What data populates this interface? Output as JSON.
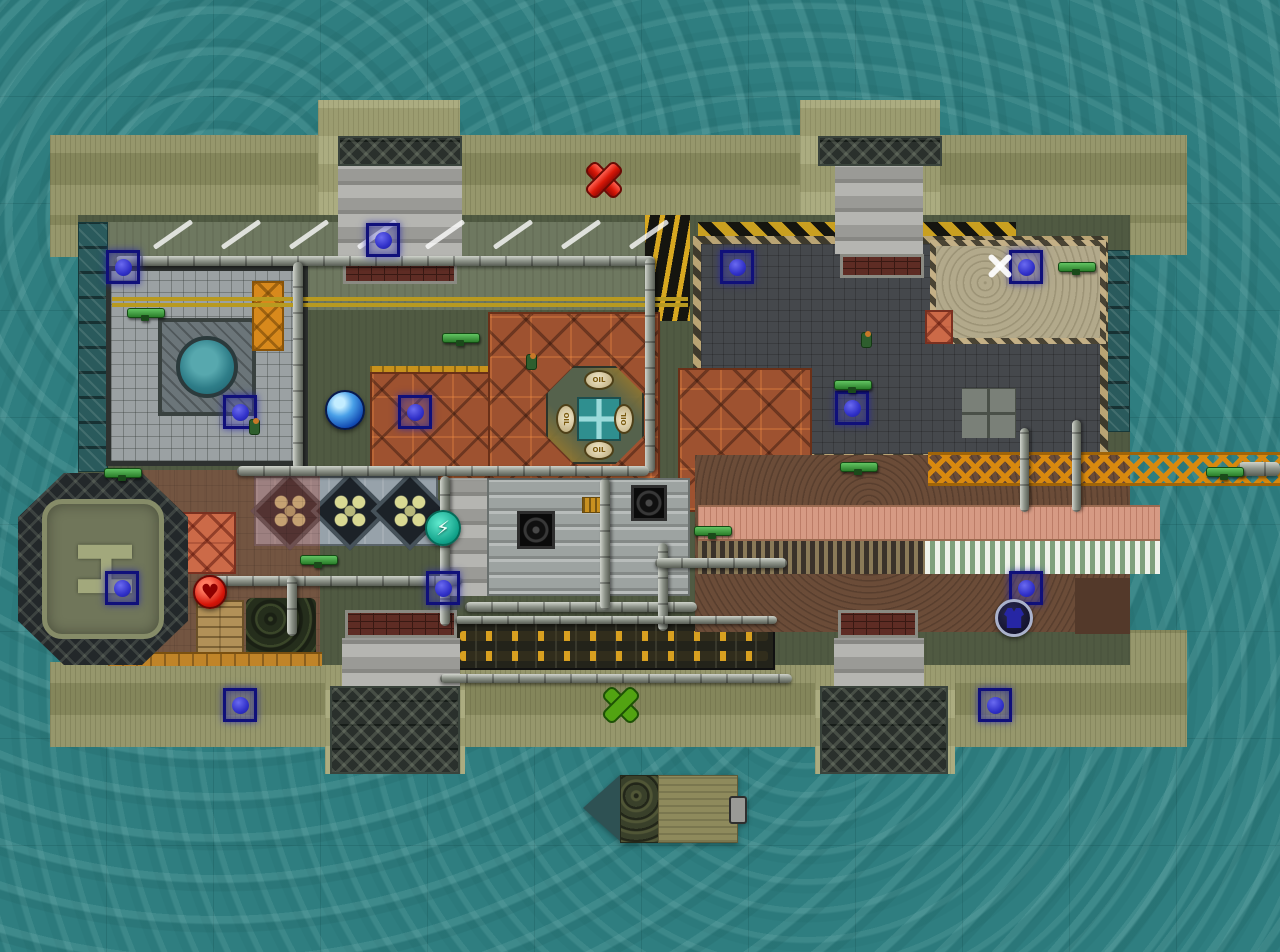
{
  "scene": {
    "name": "industrial-island-game-map",
    "width": 1280,
    "height": 952
  },
  "labels": {
    "helipad": "H",
    "oil": "OIL"
  },
  "glyphs": {
    "lightning": "⚡",
    "heart": "♥"
  },
  "colors": {
    "water": "#2f7e80",
    "dock": "#8f9163",
    "pier": "#a5a677",
    "ground": "#505a42",
    "roof_rust": "#9e5230",
    "marker_border": "#10107a",
    "marker_dot": "#3030c8",
    "pickup_red": "#d81808",
    "pickup_green": "#52a312",
    "lattice_orange": "#d8890f",
    "walkway_pink": "#d69a84",
    "sand": "#b2a98b"
  },
  "zones": [
    {
      "name": "dock-top-band",
      "type": "khaki",
      "x": 50,
      "y": 135,
      "w": 1137,
      "h": 82
    },
    {
      "name": "dock-left-col",
      "type": "khaki",
      "x": 50,
      "y": 215,
      "w": 30,
      "h": 42
    },
    {
      "name": "dock-right-top",
      "type": "khaki",
      "x": 1130,
      "y": 215,
      "w": 57,
      "h": 40
    },
    {
      "name": "dock-bottom-band",
      "type": "khaki",
      "x": 50,
      "y": 662,
      "w": 1137,
      "h": 85
    },
    {
      "name": "dock-bottom-right-step",
      "type": "khaki",
      "x": 1130,
      "y": 630,
      "w": 57,
      "h": 35
    },
    {
      "name": "pier-top-left",
      "type": "khaki-light",
      "x": 318,
      "y": 100,
      "w": 142,
      "h": 120
    },
    {
      "name": "pier-top-right",
      "type": "khaki-light",
      "x": 800,
      "y": 100,
      "w": 140,
      "h": 120
    },
    {
      "name": "pier-bottom-left",
      "type": "khaki-light",
      "x": 325,
      "y": 662,
      "w": 140,
      "h": 112
    },
    {
      "name": "pier-bottom-right",
      "type": "khaki-light",
      "x": 815,
      "y": 662,
      "w": 140,
      "h": 112
    },
    {
      "name": "facility-ground",
      "type": "base",
      "x": 78,
      "y": 215,
      "w": 1052,
      "h": 450
    },
    {
      "name": "dock-panels-left",
      "type": "teal-col",
      "x": 78,
      "y": 222,
      "w": 30,
      "h": 250
    },
    {
      "name": "dock-panels-right",
      "type": "teal-col",
      "x": 1103,
      "y": 250,
      "w": 27,
      "h": 182
    },
    {
      "name": "top-road",
      "type": "road",
      "x": 108,
      "y": 222,
      "w": 582,
      "h": 88
    },
    {
      "name": "no-stop-wavy-strip",
      "type": "wavy",
      "x": 645,
      "y": 215,
      "w": 45,
      "h": 106
    },
    {
      "name": "hazard-strip",
      "type": "hazard",
      "x": 698,
      "y": 222,
      "w": 318,
      "h": 15
    },
    {
      "name": "dark-yard",
      "type": "yard",
      "x": 693,
      "y": 236,
      "w": 415,
      "h": 226
    },
    {
      "name": "sand-patch",
      "type": "sand",
      "x": 930,
      "y": 240,
      "w": 176,
      "h": 104
    },
    {
      "name": "pallet-squares",
      "type": "pallet",
      "x": 962,
      "y": 388,
      "w": 54,
      "h": 50
    },
    {
      "name": "grid-building",
      "type": "grid-bld",
      "x": 106,
      "y": 266,
      "w": 202,
      "h": 200
    },
    {
      "name": "grid-building-ring",
      "type": "ring",
      "x": 158,
      "y": 318,
      "w": 98,
      "h": 98
    },
    {
      "name": "cooling-pool",
      "type": "pool",
      "x": 176,
      "y": 336,
      "w": 62,
      "h": 62
    },
    {
      "name": "orange-crates",
      "type": "crate-orange",
      "x": 252,
      "y": 281,
      "w": 32,
      "h": 70
    },
    {
      "name": "red-crate",
      "type": "crates-red",
      "x": 925,
      "y": 310,
      "w": 28,
      "h": 34
    },
    {
      "name": "gold-beam",
      "type": "goldstrip",
      "x": 370,
      "y": 366,
      "w": 120,
      "h": 7
    },
    {
      "name": "red-roof-left",
      "type": "redroof",
      "x": 370,
      "y": 372,
      "w": 120,
      "h": 108
    },
    {
      "name": "red-roof-center",
      "type": "redroof",
      "x": 488,
      "y": 312,
      "w": 172,
      "h": 168
    },
    {
      "name": "red-roof-right",
      "type": "redroof",
      "x": 678,
      "y": 368,
      "w": 134,
      "h": 144
    },
    {
      "name": "skylight-building",
      "type": "diamond-base",
      "x": 254,
      "y": 476,
      "w": 184,
      "h": 70
    },
    {
      "name": "skylight-diamond",
      "type": "diamond",
      "x": 262,
      "y": 483,
      "w": 56,
      "h": 56
    },
    {
      "name": "skylight-diamond",
      "type": "diamond",
      "x": 322,
      "y": 483,
      "w": 56,
      "h": 56
    },
    {
      "name": "skylight-diamond",
      "type": "diamond",
      "x": 382,
      "y": 483,
      "w": 56,
      "h": 56
    },
    {
      "name": "concrete-block",
      "type": "ramp",
      "x": 447,
      "y": 478,
      "w": 40,
      "h": 118
    },
    {
      "name": "factory-roof",
      "type": "factory",
      "x": 487,
      "y": 478,
      "w": 203,
      "h": 118
    },
    {
      "name": "roof-fan",
      "type": "fan",
      "x": 517,
      "y": 511,
      "w": 38,
      "h": 38
    },
    {
      "name": "roof-fan",
      "type": "fan",
      "x": 631,
      "y": 485,
      "w": 36,
      "h": 36
    },
    {
      "name": "roof-vent",
      "type": "goldvent",
      "x": 582,
      "y": 497,
      "w": 28,
      "h": 16
    },
    {
      "name": "conveyor-line",
      "type": "conveyor",
      "x": 453,
      "y": 622,
      "w": 322,
      "h": 48
    },
    {
      "name": "conveyor-cells",
      "type": "convrow",
      "x": 460,
      "y": 631,
      "w": 308,
      "h": 10
    },
    {
      "name": "conveyor-cells",
      "type": "convrow",
      "x": 460,
      "y": 651,
      "w": 308,
      "h": 10
    },
    {
      "name": "dirt-ground",
      "type": "dirt",
      "x": 695,
      "y": 455,
      "w": 435,
      "h": 177
    },
    {
      "name": "dirt-dark-patch",
      "type": "dirt-dark",
      "x": 1075,
      "y": 578,
      "w": 55,
      "h": 56
    },
    {
      "name": "pink-walkway",
      "type": "walkway",
      "x": 698,
      "y": 505,
      "w": 462,
      "h": 36
    },
    {
      "name": "ribbed-strip",
      "type": "ribbed",
      "x": 698,
      "y": 541,
      "w": 227,
      "h": 33
    },
    {
      "name": "awning-stripes",
      "type": "awning",
      "x": 925,
      "y": 541,
      "w": 235,
      "h": 33
    },
    {
      "name": "crane-lattice",
      "type": "lattice",
      "x": 928,
      "y": 452,
      "w": 352,
      "h": 34
    },
    {
      "name": "pink-tile-area",
      "type": "pink",
      "x": 142,
      "y": 470,
      "w": 178,
      "h": 192
    },
    {
      "name": "red-crates-stack",
      "type": "crates-red",
      "x": 178,
      "y": 512,
      "w": 58,
      "h": 62
    },
    {
      "name": "wood-crates",
      "type": "crates-wood",
      "x": 196,
      "y": 600,
      "w": 48,
      "h": 58
    },
    {
      "name": "hedge",
      "type": "bush",
      "x": 246,
      "y": 598,
      "w": 70,
      "h": 60
    },
    {
      "name": "orange-dock-strip",
      "type": "dockstrip",
      "x": 108,
      "y": 652,
      "w": 214,
      "h": 14
    },
    {
      "name": "pier-truss",
      "type": "truss",
      "x": 338,
      "y": 136,
      "w": 124,
      "h": 30
    },
    {
      "name": "pier-ramp",
      "type": "ramp",
      "x": 338,
      "y": 166,
      "w": 124,
      "h": 90
    },
    {
      "name": "pier-brick",
      "type": "brick",
      "x": 343,
      "y": 256,
      "w": 114,
      "h": 28
    },
    {
      "name": "pier-truss",
      "type": "truss",
      "x": 818,
      "y": 136,
      "w": 124,
      "h": 30
    },
    {
      "name": "pier-ramp",
      "type": "ramp",
      "x": 835,
      "y": 166,
      "w": 88,
      "h": 88
    },
    {
      "name": "pier-brick",
      "type": "brick",
      "x": 840,
      "y": 254,
      "w": 84,
      "h": 24
    },
    {
      "name": "pier-brick",
      "type": "brick",
      "x": 345,
      "y": 610,
      "w": 112,
      "h": 28
    },
    {
      "name": "pier-ramp",
      "type": "ramp",
      "x": 342,
      "y": 638,
      "w": 118,
      "h": 48
    },
    {
      "name": "pier-truss",
      "type": "truss",
      "x": 330,
      "y": 686,
      "w": 130,
      "h": 88
    },
    {
      "name": "pier-brick",
      "type": "brick",
      "x": 838,
      "y": 610,
      "w": 80,
      "h": 28
    },
    {
      "name": "pier-ramp",
      "type": "ramp",
      "x": 834,
      "y": 638,
      "w": 90,
      "h": 48
    },
    {
      "name": "pier-truss",
      "type": "truss",
      "x": 820,
      "y": 686,
      "w": 128,
      "h": 88
    },
    {
      "name": "road-yellow-line",
      "type": "yline",
      "x": 112,
      "y": 297,
      "w": 576,
      "h": 4
    },
    {
      "name": "road-yellow-line",
      "type": "yline",
      "x": 112,
      "y": 303,
      "w": 576,
      "h": 4
    }
  ],
  "pipes": [
    {
      "dir": "h",
      "x": 115,
      "y": 256,
      "w": 540,
      "h": 10
    },
    {
      "dir": "v",
      "x": 645,
      "y": 258,
      "w": 10,
      "h": 215
    },
    {
      "dir": "v",
      "x": 293,
      "y": 262,
      "w": 10,
      "h": 208
    },
    {
      "dir": "h",
      "x": 237,
      "y": 466,
      "w": 412,
      "h": 10
    },
    {
      "dir": "v",
      "x": 440,
      "y": 476,
      "w": 10,
      "h": 150
    },
    {
      "dir": "h",
      "x": 200,
      "y": 576,
      "w": 262,
      "h": 10
    },
    {
      "dir": "v",
      "x": 287,
      "y": 576,
      "w": 10,
      "h": 60
    },
    {
      "dir": "h",
      "x": 465,
      "y": 602,
      "w": 232,
      "h": 10
    },
    {
      "dir": "v",
      "x": 600,
      "y": 478,
      "w": 10,
      "h": 132
    },
    {
      "dir": "v",
      "x": 658,
      "y": 543,
      "w": 10,
      "h": 88
    },
    {
      "dir": "h",
      "x": 655,
      "y": 558,
      "w": 132,
      "h": 10
    },
    {
      "dir": "h",
      "x": 440,
      "y": 674,
      "w": 352,
      "h": 9
    },
    {
      "dir": "h",
      "x": 455,
      "y": 616,
      "w": 322,
      "h": 8
    },
    {
      "dir": "v",
      "x": 1020,
      "y": 428,
      "w": 9,
      "h": 84
    },
    {
      "dir": "v",
      "x": 1072,
      "y": 420,
      "w": 9,
      "h": 92
    },
    {
      "dir": "h",
      "x": 1238,
      "y": 462,
      "w": 42,
      "h": 14
    }
  ],
  "road_stripes": {
    "y": 232,
    "xs": [
      150,
      218,
      286,
      354,
      422,
      490,
      558,
      626
    ]
  },
  "markers": [
    {
      "x": 383,
      "y": 240
    },
    {
      "x": 123,
      "y": 267
    },
    {
      "x": 737,
      "y": 267
    },
    {
      "x": 1026,
      "y": 267
    },
    {
      "x": 240,
      "y": 412
    },
    {
      "x": 415,
      "y": 412
    },
    {
      "x": 852,
      "y": 408
    },
    {
      "x": 122,
      "y": 588
    },
    {
      "x": 443,
      "y": 588
    },
    {
      "x": 1026,
      "y": 588
    },
    {
      "x": 240,
      "y": 705
    },
    {
      "x": 995,
      "y": 705
    }
  ],
  "pickups": [
    {
      "kind": "red-x",
      "x": 602,
      "y": 178
    },
    {
      "kind": "green-x",
      "x": 619,
      "y": 703
    },
    {
      "kind": "heart",
      "x": 210,
      "y": 592
    },
    {
      "kind": "orb",
      "x": 345,
      "y": 410
    },
    {
      "kind": "bolt",
      "x": 443,
      "y": 528
    },
    {
      "kind": "armor",
      "x": 1014,
      "y": 618
    },
    {
      "kind": "white-x",
      "x": 1000,
      "y": 266
    }
  ],
  "weapons": [
    {
      "x": 145,
      "y": 313
    },
    {
      "x": 460,
      "y": 338
    },
    {
      "x": 852,
      "y": 385
    },
    {
      "x": 1076,
      "y": 267
    },
    {
      "x": 122,
      "y": 473
    },
    {
      "x": 318,
      "y": 560
    },
    {
      "x": 712,
      "y": 531
    },
    {
      "x": 858,
      "y": 467
    },
    {
      "x": 1224,
      "y": 472
    }
  ],
  "soldiers": [
    {
      "x": 531,
      "y": 362
    },
    {
      "x": 866,
      "y": 340
    },
    {
      "x": 254,
      "y": 427
    }
  ]
}
